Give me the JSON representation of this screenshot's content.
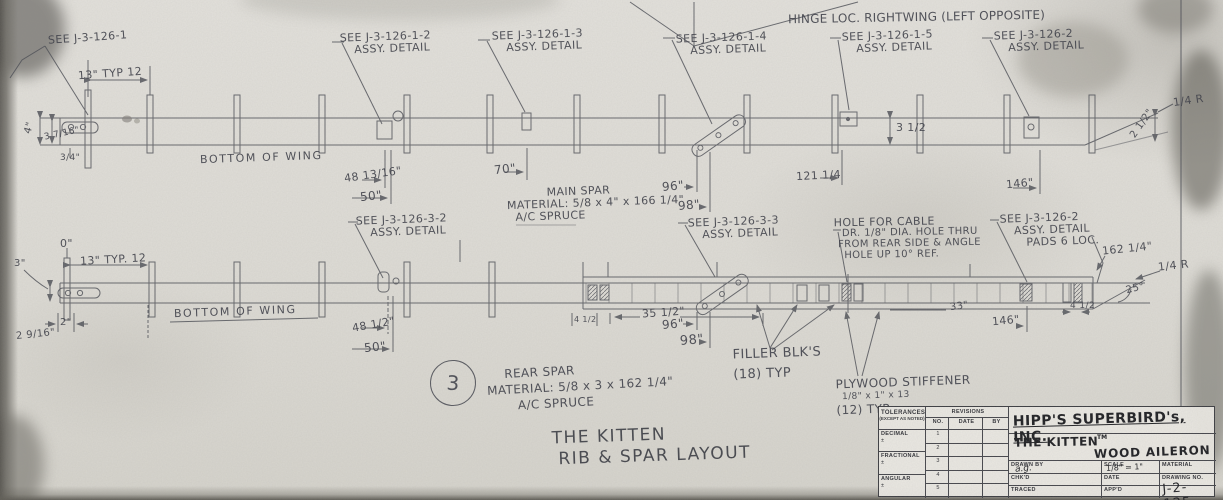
{
  "sheet": {
    "title_line1": "THE KITTEN",
    "title_line2": "RIB & SPAR LAYOUT"
  },
  "top_view": {
    "ref_callout": "SEE J-3-126-1",
    "spacing_dim": "13\" TYP 12",
    "hinge_note": "HINGE LOC. RIGHTWING (LEFT OPPOSITE)",
    "bottom_of_wing": "BOTTOM OF WING",
    "callouts": [
      {
        "l1": "SEE J-3-126-1-2",
        "l2": "ASSY. DETAIL"
      },
      {
        "l1": "SEE J-3-126-1-3",
        "l2": "ASSY. DETAIL"
      },
      {
        "l1": "SEE J-3-126-1-4",
        "l2": "ASSY. DETAIL"
      },
      {
        "l1": "SEE J-3-126-1-5",
        "l2": "ASSY. DETAIL"
      },
      {
        "l1": "SEE J-3-126-2",
        "l2": "ASSY. DETAIL"
      }
    ],
    "note_line1": "MAIN SPAR",
    "note_line2": "MATERIAL: 5/8 x 4\" x 166 1/4\"",
    "note_line3": "A/C SPRUCE",
    "dims": {
      "d1": "4\"",
      "d2": "3 7/16\"",
      "d3": "3/4\"",
      "d4": "48 13/16\"",
      "d5": "50\"",
      "d6": "70\"",
      "d7": "96\"",
      "d8": "98\"",
      "d9": "121 1/4",
      "d10": "3 1/2",
      "d11": "146\"",
      "d12": "1/4 R",
      "d13": "2 1/2\""
    }
  },
  "bottom_view": {
    "zero_ref": "0\"",
    "spacing_dim": "13\" TYP. 12",
    "bottom_of_wing": "BOTTOM OF WING",
    "callouts": [
      {
        "l1": "SEE J-3-126-3-2",
        "l2": "ASSY. DETAIL"
      },
      {
        "l1": "SEE J-3-126-3-3",
        "l2": "ASSY. DETAIL"
      },
      {
        "l1": "SEE J-3-126-2",
        "l2": "ASSY. DETAIL",
        "l3": "PADS 6 LOC."
      }
    ],
    "hole_note": [
      "HOLE FOR CABLE",
      "DR. 1/8\" DIA. HOLE THRU",
      "FROM REAR SIDE & ANGLE",
      "HOLE UP 10° REF."
    ],
    "filler_note": [
      "FILLER BLK'S",
      "(18) TYP"
    ],
    "plywood_note": [
      "PLYWOOD STIFFENER",
      "1/8\" x 1\" x 13",
      "(12) TYP."
    ],
    "rear_spar_bubble": "3",
    "rear_spar_note": [
      "REAR SPAR",
      "MATERIAL: 5/8 x 3 x 162 1/4\"",
      "A/C SPRUCE"
    ],
    "dims": {
      "d1": "3\"",
      "d2": "2\"",
      "d3": "2 9/16\"",
      "d4": "48 1/2\"",
      "d5": "50\"",
      "d6": "35 1/2\"",
      "d7": "96\"",
      "d8": "98\"",
      "d9": "4 1/2",
      "d10": "33\"",
      "d11": "146\"",
      "d12": "162 1/4\"",
      "d13": "1/4 R",
      "d14": "25°"
    }
  },
  "title_block": {
    "tolerances_header": "TOLERANCES",
    "tolerances_sub": "(EXCEPT AS NOTED)",
    "tolerance_rows": [
      {
        "label": "DECIMAL",
        "pm": "±"
      },
      {
        "label": "FRACTIONAL",
        "pm": "±"
      },
      {
        "label": "ANGULAR",
        "pm": "±"
      }
    ],
    "revisions_header": "REVISIONS",
    "rev_col_no": "NO.",
    "rev_col_date": "DATE",
    "rev_col_by": "BY",
    "rev_rows": [
      "1",
      "2",
      "3",
      "4",
      "5"
    ],
    "company": "HIPP'S SUPERBIRD's, INC.",
    "product": "THE KITTEN",
    "trademark": "TM",
    "part": "WOOD AILERON",
    "drawn_by_label": "DRAWN BY",
    "drawn_by_value": "a.g.",
    "scale_label": "SCALE",
    "scale_value": "1/8\" = 1\"",
    "material_label": "MATERIAL",
    "chkd_label": "CHK'D",
    "date_label": "DATE",
    "drawing_no_label": "DRAWING NO.",
    "traced_label": "TRACED",
    "appd_label": "APP'D",
    "drawing_no_value": "J-2-125"
  }
}
